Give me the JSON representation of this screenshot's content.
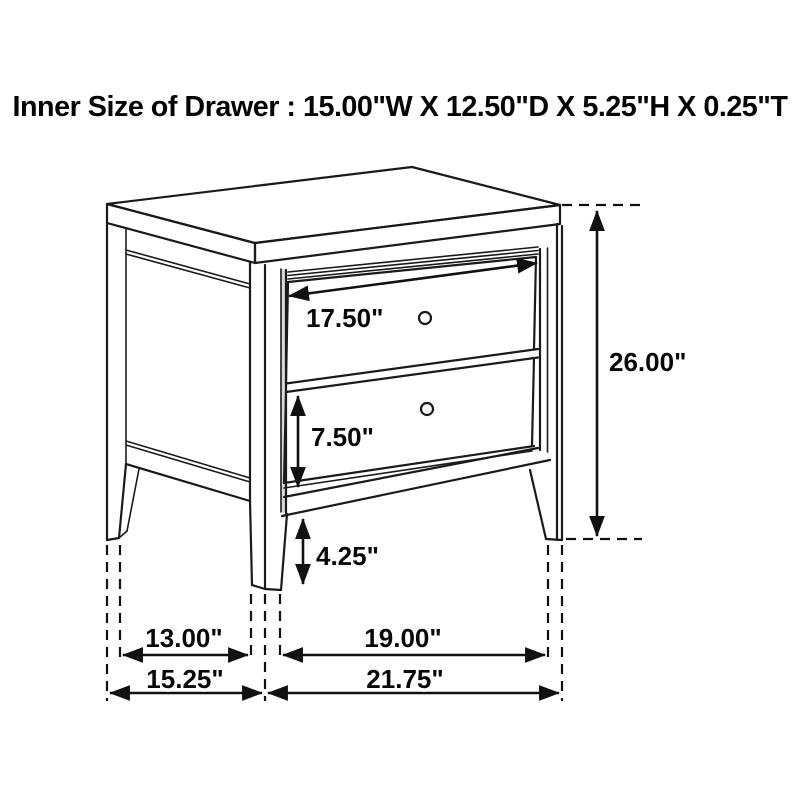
{
  "title": "Inner Size of Drawer : 15.00\"W X 12.50\"D X 5.25\"H X 0.25\"T",
  "diagram": {
    "subject": "two-drawer nightstand dimension line drawing",
    "line_color": "#1a1a1a",
    "background_color": "#ffffff",
    "shade_color": "#d9d9d9"
  },
  "labels": {
    "drawer_front_width": "17.50\"",
    "drawer_front_height": "7.50\"",
    "leg_clearance_height": "4.25\"",
    "overall_height": "26.00\"",
    "side_leg_span": "13.00\"",
    "overall_depth": "15.25\"",
    "front_leg_span": "19.00\"",
    "overall_width": "21.75\""
  }
}
